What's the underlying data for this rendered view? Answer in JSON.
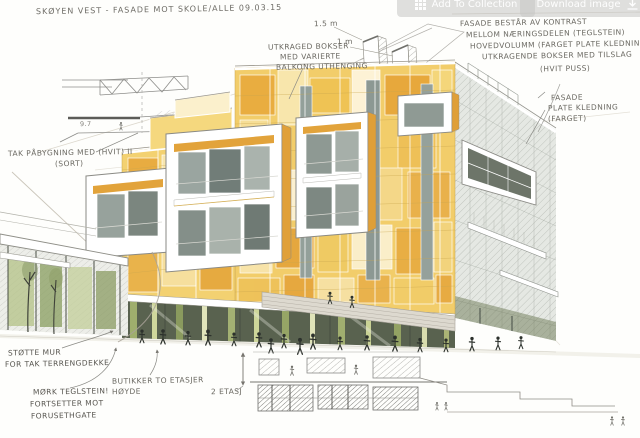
{
  "toolbar": {
    "add_to_collection_label": "Add To Collection",
    "download_label": "Download image"
  },
  "annotations": {
    "title": "SKØYEN VEST - FASADE MOT SKOLE/ALLE 09.03.15",
    "facade_note": {
      "line1": "FASADE BESTÅR AV KONTRAST",
      "line2": "MELLOM NÆRINGSDELEN (TEGLSTEIN)",
      "line3": "HOVEDVOLUMM (FARGET PLATE KLEDNING)",
      "line4": "UTKRAGENDE BOKSER MED TILSLAG",
      "line5": "(HVIT PUSS)"
    },
    "plate_note": {
      "line1": "FASADE",
      "line2": "PLATE KLEDNING",
      "line3": "(FARGET)"
    },
    "boxes_note": {
      "line1": "UTKRAGED BOKSER",
      "line2": "MED VARIERTE",
      "line3": "BALKONG UTHENGING"
    },
    "roof_note": {
      "line1": "TAK PÅBYGNING MED (HVIT) II",
      "line2": "(SORT)"
    },
    "wall_note": {
      "line1": "STØTTE MUR",
      "line2": "FOR TAK TERRENGDEKKE"
    },
    "brick_note": {
      "line1": "MØRK TEGLSTEIN!",
      "line2": "FORTSETTER MOT",
      "line3": "FORUSETHGATE"
    },
    "shops_note": {
      "line1": "BUTIKKER TO ETASJER",
      "line2": "HØYDE"
    },
    "floors_note": "2 ETASJ",
    "dim_large": "1.5 m",
    "dim_small": "1 m",
    "section_dim": "9.7"
  },
  "palette": {
    "facade_amber": "#e2a33c",
    "facade_gold": "#f2cd6a",
    "facade_pale": "#f8e7b0",
    "facade_cream": "#fbf3da",
    "glass_olive": "#9fae6d",
    "glass_dark": "#59624f",
    "pencil_gray": "#8a8a85",
    "paper": "#ffffff"
  }
}
